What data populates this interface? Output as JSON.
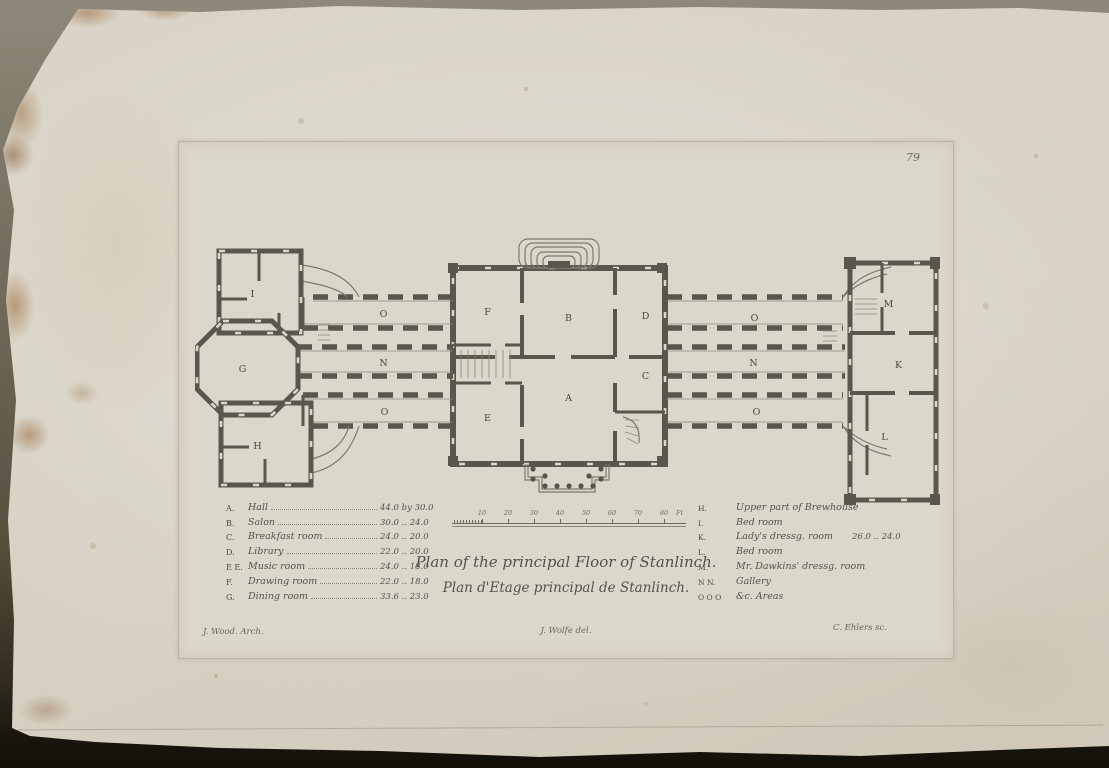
{
  "plate": {
    "number": "79",
    "title_en": "Plan of the principal Floor of Stanlinch.",
    "title_fr": "Plan d'Etage principal de Stanlinch.",
    "signature_architect": "J. Wood. Arch.",
    "signature_delineator": "J. Wolfe del.",
    "signature_engraver": "C. Ehlers sc."
  },
  "legend_left": [
    {
      "letter": "A.",
      "name": "Hall",
      "dims": "44.0 by 30.0"
    },
    {
      "letter": "B.",
      "name": "Salon",
      "dims": "30.0 .. 24.0"
    },
    {
      "letter": "C.",
      "name": "Breakfast room",
      "dims": "24.0 .. 20.0"
    },
    {
      "letter": "D.",
      "name": "Library",
      "dims": "22.0 .. 20.0"
    },
    {
      "letter": "E E.",
      "name": "Music room",
      "dims": "24.0 .. 18.0"
    },
    {
      "letter": "F.",
      "name": "Drawing room",
      "dims": "22.0 .. 18.0"
    },
    {
      "letter": "G.",
      "name": "Dining room",
      "dims": "33.6 .. 23.0"
    }
  ],
  "legend_right": [
    {
      "letter": "H.",
      "name": "Upper part of Brewhouse",
      "dims": ""
    },
    {
      "letter": "I.",
      "name": "Bed room",
      "dims": ""
    },
    {
      "letter": "K.",
      "name": "Lady's dressg. room",
      "dims": "26.0 .. 24.0"
    },
    {
      "letter": "L.",
      "name": "Bed room",
      "dims": ""
    },
    {
      "letter": "M.",
      "name": "Mr. Dawkins' dressg. room",
      "dims": ""
    },
    {
      "letter": "N N.",
      "name": "Gallery",
      "dims": ""
    },
    {
      "letter": "O O O",
      "name": "&c. Areas",
      "dims": ""
    }
  ],
  "scale": {
    "ticks": [
      "10",
      "20",
      "30",
      "40",
      "50",
      "60",
      "70",
      "80"
    ],
    "unit": "Ft"
  },
  "plan": {
    "labels": [
      "I",
      "G",
      "H",
      "O",
      "N",
      "O",
      "F",
      "E",
      "B",
      "D",
      "A",
      "C",
      "O",
      "N",
      "O",
      "M",
      "K",
      "L"
    ]
  }
}
